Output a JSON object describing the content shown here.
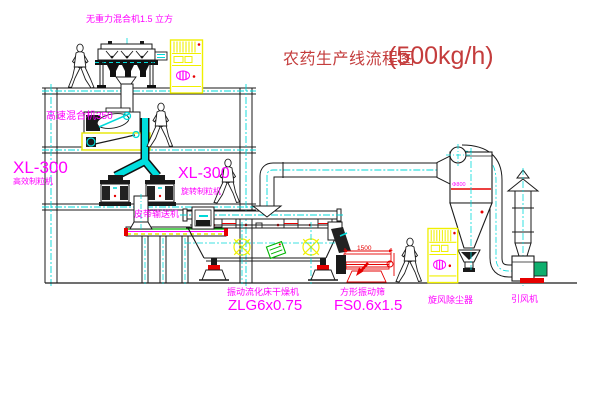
{
  "title": {
    "text": "农药生产线流程图",
    "capacity": "(500kg/h)"
  },
  "equipment_labels": {
    "gravity_mixer": "无重力混合机1.5 立方",
    "high_speed_mixer": "高速混合机350",
    "granulator_left_model": "XL-300",
    "granulator_left_name": "高效制粒机",
    "granulator_right_model": "XL-300",
    "granulator_right_name": "旋转制粒机",
    "belt_conveyor": "皮带输送机",
    "fluid_bed_dryer_name": "振动流化床干燥机",
    "fluid_bed_dryer_model": "ZLG6x0.75",
    "vibrating_sieve_name": "方形振动筛",
    "vibrating_sieve_model": "FS0.6x1.5",
    "cyclone_name": "旋风除尘器",
    "fan_name": "引风机"
  },
  "dimensions": {
    "sieve_length": "1500",
    "cyclone_size": "Φ800"
  },
  "colors": {
    "label_magenta": "#ff00ff",
    "centerline_cyan": "#00d9d9",
    "accent_yellow": "#f0f000",
    "accent_red": "#e60000",
    "accent_green": "#00b400",
    "title_red": "#c43c3c",
    "line_black": "#1a1a1a"
  }
}
